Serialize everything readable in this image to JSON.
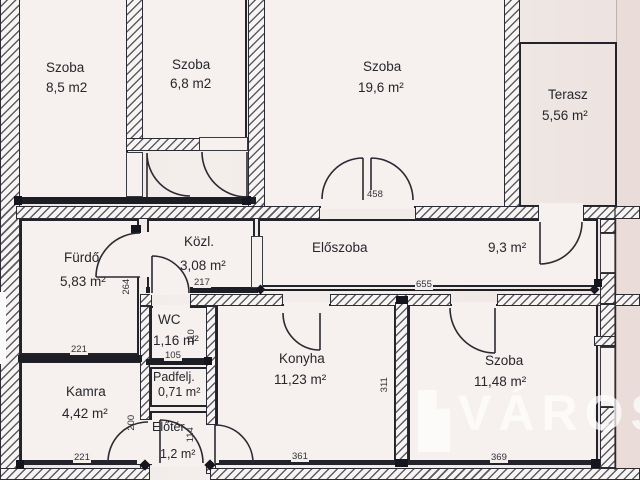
{
  "drawing": {
    "type": "apartment-floor-plan",
    "colors": {
      "paper": "#f1ebe8",
      "ink": "#23232c",
      "hatch": "#54545f",
      "watermark": "rgba(255,255,255,0.72)"
    }
  },
  "rooms": {
    "szoba85": {
      "name": "Szoba",
      "area": "8,5 m2"
    },
    "szoba68": {
      "name": "Szoba",
      "area": "6,8 m2"
    },
    "szoba196": {
      "name": "Szoba",
      "area": "19,6 m²"
    },
    "terasz": {
      "name": "Terasz",
      "area": "5,56 m²"
    },
    "furdo": {
      "name": "Fürdő",
      "area": "5,83 m²"
    },
    "kozl": {
      "name": "Közl.",
      "area": "3,08 m²"
    },
    "eloszoba": {
      "name": "Előszoba",
      "area": "9,3 m²"
    },
    "wc": {
      "name": "WC",
      "area": "1,16 m²"
    },
    "kamra": {
      "name": "Kamra",
      "area": "4,42 m²"
    },
    "padfelj": {
      "name": "Padfelj.",
      "area": "0,71 m²"
    },
    "eloter": {
      "name": "Előtér",
      "area": "1,2 m²"
    },
    "konyha": {
      "name": "Konyha",
      "area": "11,23 m²"
    },
    "szoba1148": {
      "name": "Szoba",
      "area": "11,48 m²"
    }
  },
  "dimensions": {
    "d458": "458",
    "d264": "264",
    "d217": "217",
    "d655": "655",
    "d221_top": "221",
    "d105": "105",
    "d110": "110",
    "d200": "200",
    "d114": "114",
    "d221_bottom": "221",
    "d361": "361",
    "d311": "311",
    "d369": "369"
  },
  "watermark": {
    "text": "VÁROS"
  }
}
